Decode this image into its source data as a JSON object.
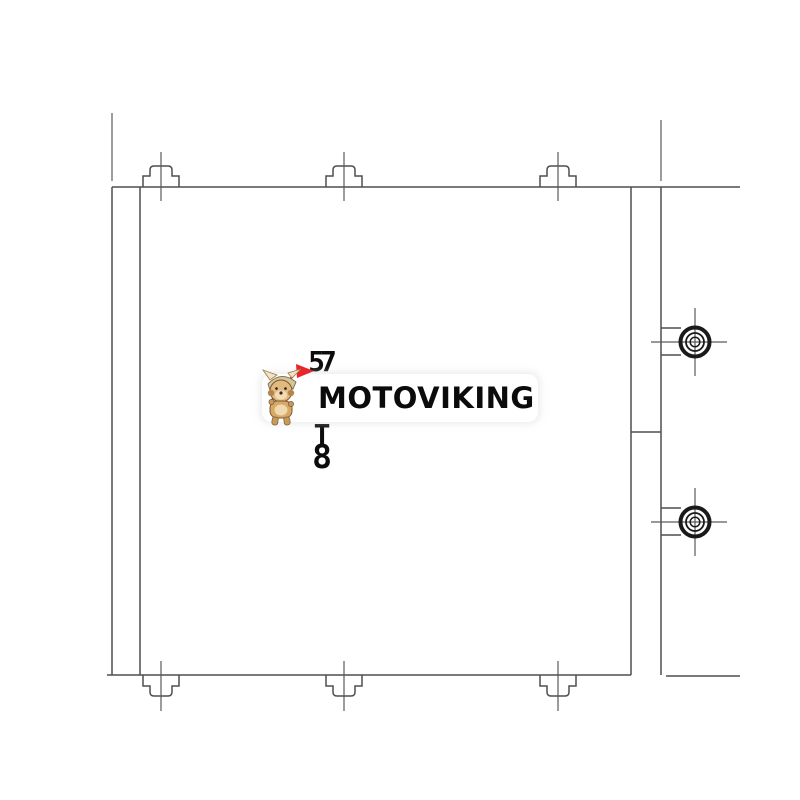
{
  "watermark": {
    "brand": "MOTOVIKING",
    "badge_bg": "#ffffff",
    "text_color": "#0b0b0b",
    "accent_color": "#e8252a",
    "mascot": "viking-dog-mascot"
  },
  "drawing": {
    "subject": "engine-oil-cooler-technical-line-drawing-front-view",
    "line_color": "#4f4f4f",
    "circle_color": "#1a1a1a",
    "vertical_label_top": "57",
    "vertical_label_mid": "T",
    "vertical_label_bottom": "8",
    "top_bolt_count": 3,
    "bottom_bolt_count": 3,
    "side_port_count": 2
  }
}
